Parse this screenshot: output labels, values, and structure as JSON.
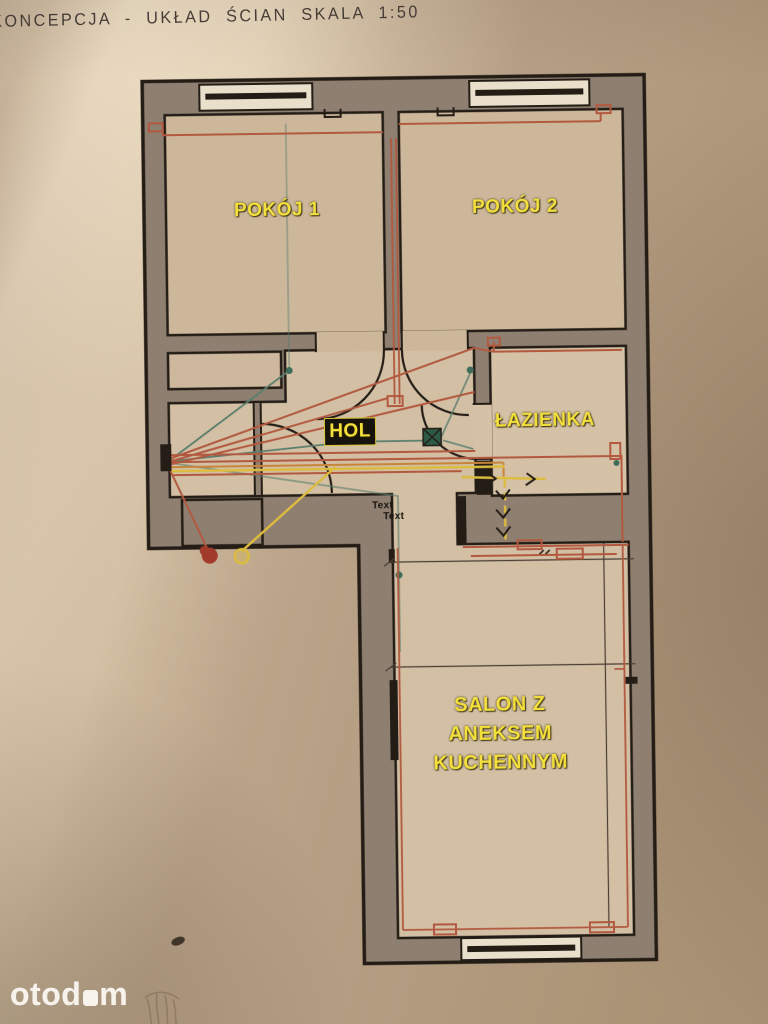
{
  "page": {
    "title": "KONCEPCJA - UKŁAD ŚCIAN SKALA 1:50",
    "scale": "1:50"
  },
  "plan": {
    "rooms": {
      "room1": "POKÓJ 1",
      "room2": "POKÓJ 2",
      "hall": "HOL",
      "bathroom": "ŁAZIENKA",
      "living_line1": "SALON Z",
      "living_line2": "ANEKSEM",
      "living_line3": "KUCHENNYM"
    },
    "annotations": {
      "text_placeholder_1": "Text",
      "text_placeholder_2": "Text"
    },
    "colors": {
      "label_yellow": "#f3e03c",
      "wall_gray": "#8e7f71",
      "line_black": "#241d16",
      "floor_beige": "#ccb79b",
      "window_white": "#eadfca",
      "wire_red": "#b2593f",
      "wire_orange": "#c8853a",
      "wire_yellow": "#dcbc3e",
      "wire_teal": "#5a7e6d",
      "junction_green": "#2c5a44",
      "blob_red": "#a23a2c",
      "paper": "#b49d82"
    }
  },
  "watermark": {
    "brand_prefix": "otod",
    "brand_suffix": "m"
  }
}
